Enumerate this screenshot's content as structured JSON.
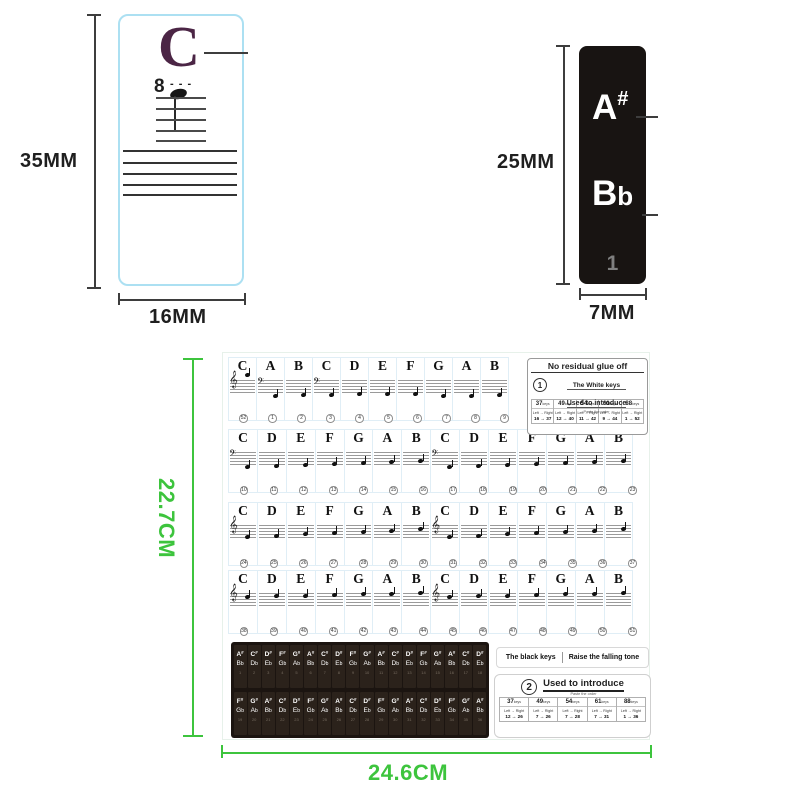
{
  "colors": {
    "green": "#3dc43d",
    "plum": "#4b2545",
    "black_sticker": "#181412",
    "panel": "#1b1410"
  },
  "icons": {
    "treble_clef": "𝄞",
    "bass_clef": "𝄢"
  },
  "top_left": {
    "letter": "C",
    "octave": "8",
    "octave_dashes": "- - -",
    "height_label": "35MM",
    "width_label": "16MM"
  },
  "top_right": {
    "note_sharp": "A",
    "sharp_sign": "#",
    "note_flat": "B",
    "flat_sign": "b",
    "index": "1",
    "height_label": "25MM",
    "width_label": "7MM"
  },
  "sheet": {
    "height_label": "22.7CM",
    "width_label": "24.6CM",
    "white_rows": [
      {
        "letters": [
          "C",
          "A",
          "B",
          "C",
          "D",
          "E",
          "F",
          "G",
          "A",
          "B"
        ],
        "clefs": [
          "treble",
          "bass",
          "",
          "bass",
          "",
          "",
          "",
          "",
          "",
          ""
        ],
        "numbers": [
          "52",
          "1",
          "2",
          "3",
          "4",
          "5",
          "6",
          "7",
          "8",
          "9"
        ]
      },
      {
        "letters": [
          "C",
          "D",
          "E",
          "F",
          "G",
          "A",
          "B",
          "C",
          "D",
          "E",
          "F",
          "G",
          "A",
          "B"
        ],
        "clefs": [
          "bass",
          "",
          "",
          "",
          "",
          "",
          "",
          "bass",
          "",
          "",
          "",
          "",
          "",
          ""
        ],
        "numbers": [
          "10",
          "11",
          "12",
          "13",
          "14",
          "15",
          "16",
          "17",
          "18",
          "19",
          "20",
          "21",
          "22",
          "23"
        ]
      },
      {
        "letters": [
          "C",
          "D",
          "E",
          "F",
          "G",
          "A",
          "B",
          "C",
          "D",
          "E",
          "F",
          "G",
          "A",
          "B"
        ],
        "clefs": [
          "treble",
          "",
          "",
          "",
          "",
          "",
          "",
          "treble",
          "",
          "",
          "",
          "",
          "",
          ""
        ],
        "numbers": [
          "24",
          "25",
          "26",
          "27",
          "28",
          "29",
          "30",
          "31",
          "32",
          "33",
          "34",
          "35",
          "36",
          "37"
        ]
      },
      {
        "letters": [
          "C",
          "D",
          "E",
          "F",
          "G",
          "A",
          "B",
          "C",
          "D",
          "E",
          "F",
          "G",
          "A",
          "B"
        ],
        "clefs": [
          "treble",
          "",
          "",
          "",
          "",
          "",
          "",
          "treble",
          "",
          "",
          "",
          "",
          "",
          ""
        ],
        "numbers": [
          "38",
          "39",
          "40",
          "41",
          "42",
          "43",
          "44",
          "45",
          "46",
          "47",
          "48",
          "49",
          "50",
          "51"
        ]
      }
    ],
    "white_info": {
      "title": "No residual glue off",
      "badge": "1",
      "line1": "The White keys",
      "line2": "Used to introduce",
      "note": "Paste the order",
      "table": {
        "keys": [
          "37",
          "49",
          "54",
          "61",
          "88"
        ],
        "unit": "keys",
        "dir": "Left → Right",
        "ranges": [
          "16 → 37",
          "12 → 40",
          "11 → 42",
          "9 → 44",
          "1 → 52"
        ]
      }
    },
    "black_rows": [
      {
        "sharps": [
          "A#",
          "C#",
          "D#",
          "F#",
          "G#",
          "A#",
          "C#",
          "D#",
          "F#",
          "G#",
          "A#",
          "C#",
          "D#",
          "F#",
          "G#",
          "A#",
          "C#",
          "D#"
        ],
        "flats": [
          "Bb",
          "Db",
          "Eb",
          "Gb",
          "Ab",
          "Bb",
          "Db",
          "Eb",
          "Gb",
          "Ab",
          "Bb",
          "Db",
          "Eb",
          "Gb",
          "Ab",
          "Bb",
          "Db",
          "Eb"
        ],
        "numbers": [
          "1",
          "2",
          "3",
          "4",
          "5",
          "6",
          "7",
          "8",
          "9",
          "10",
          "11",
          "12",
          "13",
          "14",
          "15",
          "16",
          "17",
          "18"
        ]
      },
      {
        "sharps": [
          "F#",
          "G#",
          "A#",
          "C#",
          "D#",
          "F#",
          "G#",
          "A#",
          "C#",
          "D#",
          "F#",
          "G#",
          "A#",
          "C#",
          "D#",
          "F#",
          "G#",
          "A#"
        ],
        "flats": [
          "Gb",
          "Ab",
          "Bb",
          "Db",
          "Eb",
          "Gb",
          "Ab",
          "Bb",
          "Db",
          "Eb",
          "Gb",
          "Ab",
          "Bb",
          "Db",
          "Eb",
          "Gb",
          "Ab",
          "Bb"
        ],
        "numbers": [
          "19",
          "20",
          "21",
          "22",
          "23",
          "24",
          "25",
          "26",
          "27",
          "28",
          "29",
          "30",
          "31",
          "32",
          "33",
          "34",
          "35",
          "36"
        ]
      }
    ],
    "black_info": {
      "header_left": "The black keys",
      "header_right": "Raise the falling tone",
      "badge": "2",
      "title": "Used to introduce",
      "note": "Paste the order",
      "table": {
        "keys": [
          "37",
          "49",
          "54",
          "61",
          "88"
        ],
        "unit": "keys",
        "dir": "Left → Right",
        "ranges": [
          "12 → 26",
          "7 → 26",
          "7 → 28",
          "7 → 31",
          "1 → 36"
        ]
      }
    }
  }
}
